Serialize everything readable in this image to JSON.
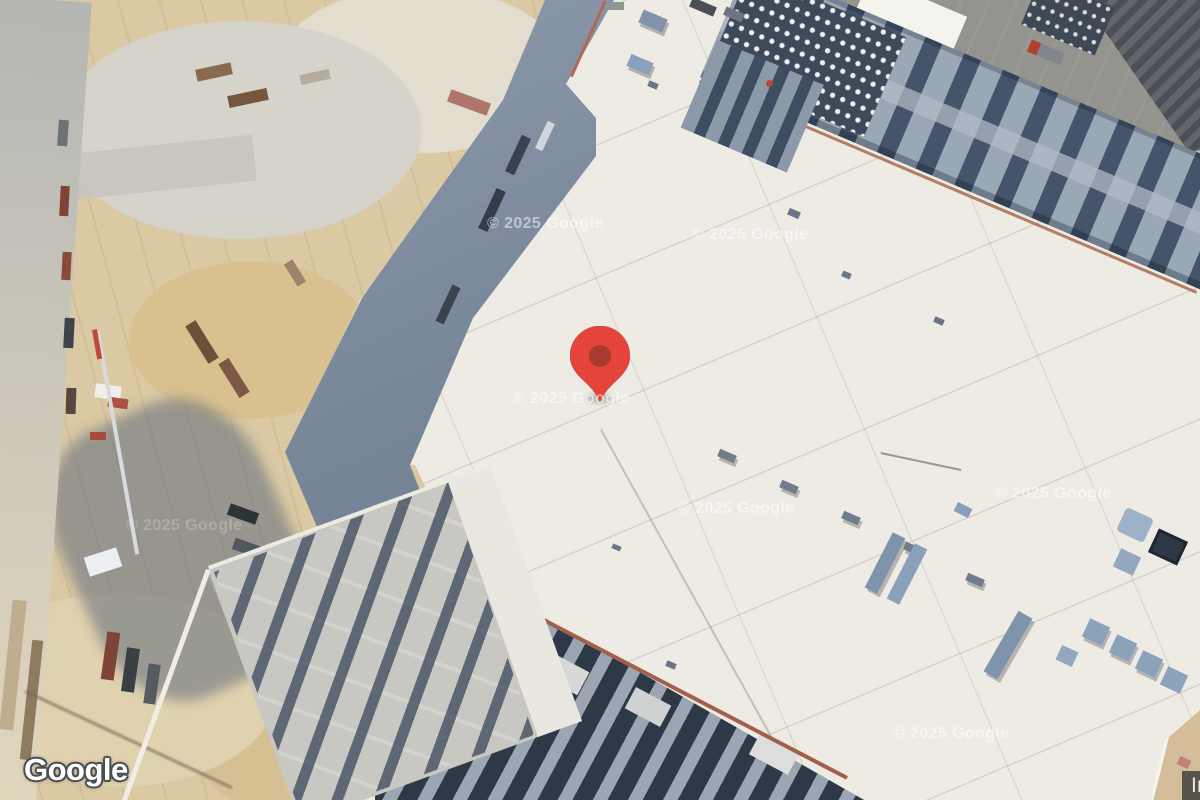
{
  "map": {
    "logo_text": "Google",
    "attribution_text": "Imagery ©2025 Airbus, CNES / Airbus, Maxar Technologies",
    "watermark_text": "© 2025 Google",
    "marker": {
      "type": "location-pin",
      "fill_color": "#e5443a",
      "dot_color": "#a83a30"
    },
    "colors": {
      "roof_white": "#edebe4",
      "sand": "#dac9a3",
      "hvac_band_dark": "#4b5a6d",
      "asphalt_gray": "#95938e",
      "rust_edge": "#a86a50",
      "attribution_bg": "rgba(55,55,55,0.8)",
      "watermark": "rgba(255,255,255,0.5)"
    }
  }
}
